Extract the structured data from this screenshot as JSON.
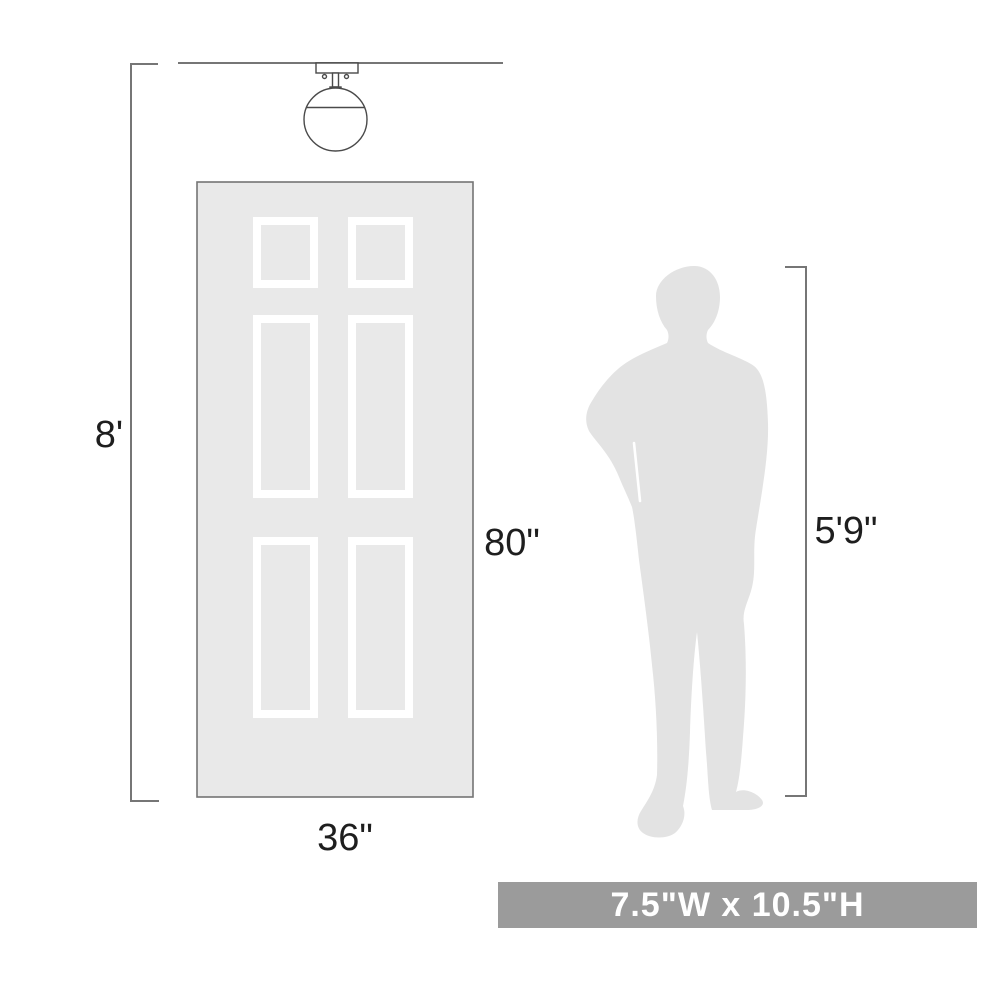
{
  "colors": {
    "background": "#ffffff",
    "line": "#767676",
    "fixture_line": "#4a4a4a",
    "text": "#1e1e1e",
    "door_fill": "#e9e9e9",
    "door_border": "#747474",
    "panel_frame": "#ffffff",
    "silhouette": "#e3e3e3",
    "banner_bg": "#9b9b9b",
    "banner_text": "#ffffff"
  },
  "diagram": {
    "ceiling": {
      "height_label": "8'"
    },
    "door": {
      "height_label": "80\"",
      "width_label": "36\""
    },
    "person": {
      "height_label": "5'9\""
    },
    "banner": {
      "size_text": "7.5\"W x 10.5\"H"
    }
  }
}
